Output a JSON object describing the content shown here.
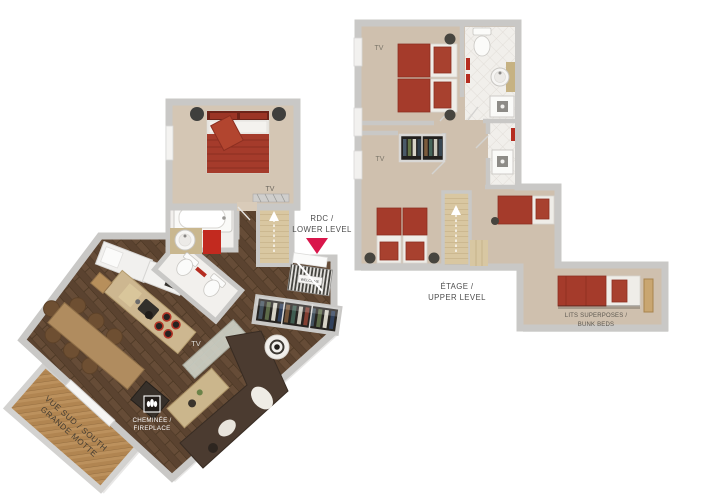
{
  "colors": {
    "accent_red": "#d9164b",
    "bed_red": "#a53b2b",
    "wall_gray": "#c9c8c6",
    "wood_dark": "#5b4330",
    "wood_light": "#b18551",
    "carpet_tan": "#cfc0ae",
    "label_text": "#4d4d4d"
  },
  "lower_level": {
    "marker_label": {
      "line1": "RDC /",
      "line2": "LOWER LEVEL"
    },
    "bedroom": {
      "tv_label": "TV"
    },
    "living_room": {
      "tv_label": "TV"
    },
    "fireplace_label": {
      "line1": "CHEMINÉE /",
      "line2": "FIREPLACE"
    },
    "balcony_label": {
      "line1": "VUE SUD / SOUTH",
      "line2": "GRANDE MOTTE"
    },
    "doormat_label": "WELCOME"
  },
  "upper_level": {
    "label": {
      "line1": "ÉTAGE /",
      "line2": "UPPER LEVEL"
    },
    "bedroom1": {
      "tv_label": "TV"
    },
    "bedroom2": {
      "tv_label": "TV"
    },
    "bunk_label": {
      "line1": "LITS SUPERPOSES /",
      "line2": "BUNK BEDS"
    }
  }
}
